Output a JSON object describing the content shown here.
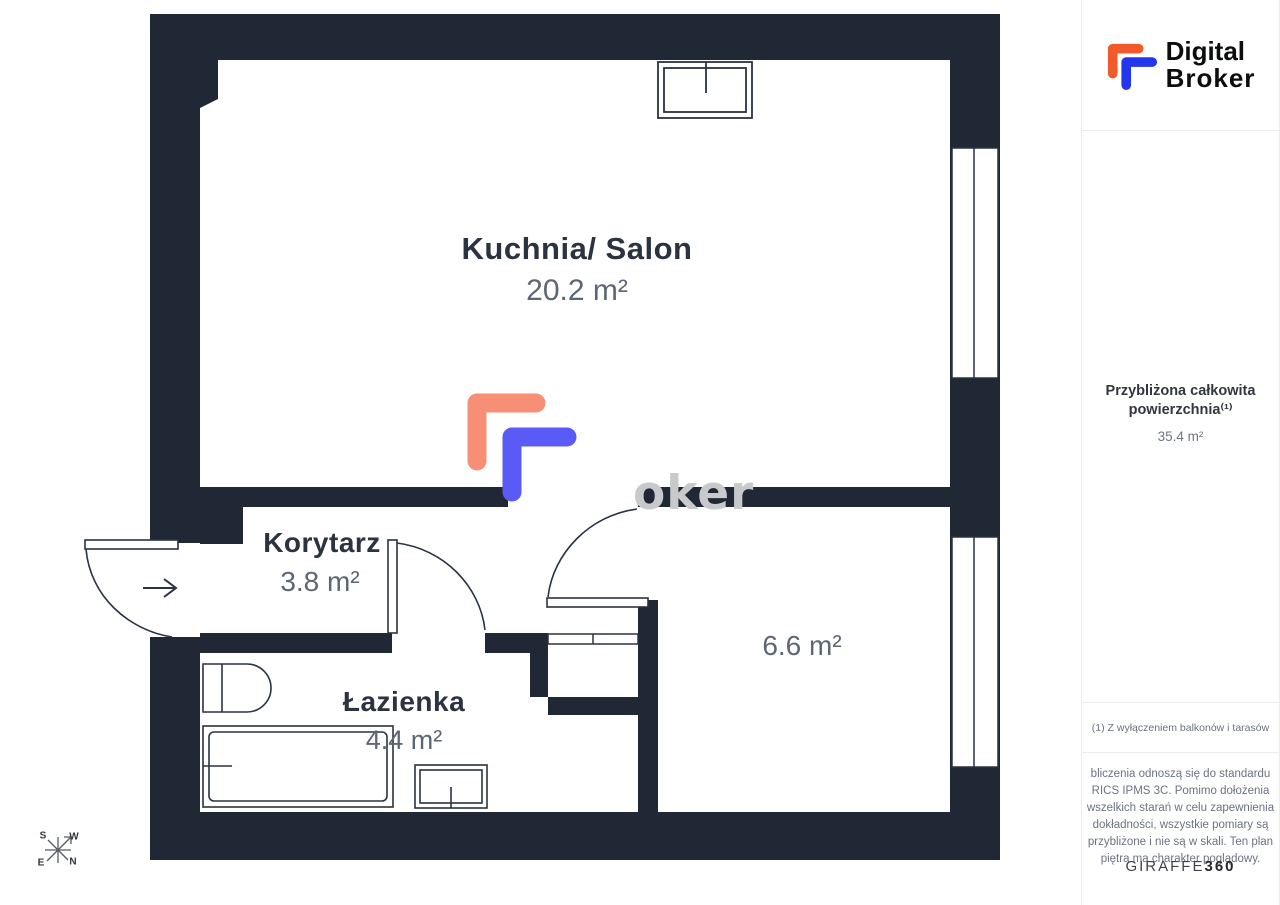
{
  "theme": {
    "wall": "#1f2834",
    "line": "#2a3342",
    "label_dark": "#2b3240",
    "label_gray": "#5d6672",
    "watermark_gray": "#c7c9cb",
    "brand_orange": "#f15b2b",
    "brand_blue": "#2236ee",
    "plan_orange": "#f68f76",
    "plan_blue": "#5a5af7",
    "sidebar_border": "#ececec",
    "footnote_gray": "#6b7280",
    "text_black": "#0c0d0e"
  },
  "floorplan": {
    "watermark_text": "oker",
    "rooms": {
      "kitchen": {
        "name": "Kuchnia/ Salon",
        "area": "20.2 m²"
      },
      "hallway": {
        "name": "Korytarz",
        "area": "3.8 m²"
      },
      "bathroom": {
        "name": "Łazienka",
        "area": "4.4 m²"
      },
      "second_room": {
        "area": "6.6 m²"
      }
    },
    "compass": {
      "top_left": "S",
      "top_right": "W",
      "bottom_left": "E",
      "bottom_right": "N"
    }
  },
  "sidebar": {
    "logo_line1": "Digital",
    "logo_line2": "Broker",
    "total_area_title_line1": "Przybliżona całkowita",
    "total_area_title_line2": "powierzchnia⁽¹⁾",
    "total_area_value": "35.4 m²",
    "footnote": "(1) Z wyłączeniem balkonów i tarasów",
    "disclaimer_lines": [
      "bliczenia odnoszą się do standardu",
      "RICS IPMS 3C. Pomimo dołożenia",
      "wszelkich starań w celu zapewnienia",
      "dokładności, wszystkie pomiary są",
      "przybliżone i nie są w skali. Ten plan",
      "piętra ma charakter poglądowy."
    ],
    "brand_footer_regular": "GIRAFFE",
    "brand_footer_bold": "360"
  }
}
